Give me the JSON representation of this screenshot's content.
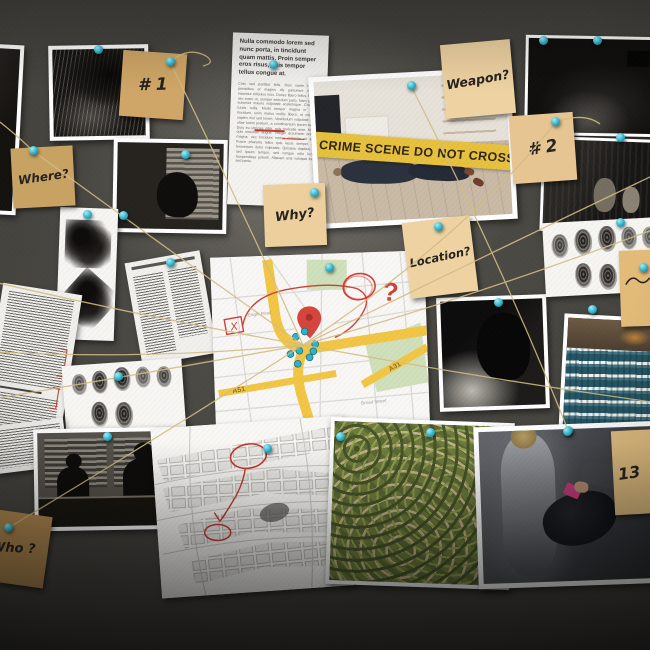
{
  "scene": {
    "description": "Detective evidence board: photos, sticky notes, maps, fingerprints and newspaper clippings connected by string and turquoise push pins",
    "surface": "gray felt pinboard"
  },
  "colors": {
    "board_felt": "#46443f",
    "sticky_note": "#e3c491",
    "push_pin": "#2fb3c9",
    "string": "#d2bc84",
    "crime_tape": "#e7c13d",
    "red_annotation": "#cc3b32"
  },
  "notes": {
    "n1": {
      "label": "# 1"
    },
    "where": {
      "label": "Where?"
    },
    "why": {
      "label": "Why?"
    },
    "weapon": {
      "label": "Weapon?"
    },
    "n2": {
      "label": "# 2"
    },
    "location": {
      "label": "Location?"
    },
    "n13": {
      "label": "13"
    },
    "who": {
      "label": "Who ?"
    },
    "edge": {
      "label": ""
    }
  },
  "crime_scene": {
    "tape_text": "CRIME SCENE DO NOT CROSS"
  },
  "newspaper": {
    "headline": "Nulla commodo lorem sed nunc porta, in tincidunt quam mattis. Proin semper eros risus, quis tempor tellus congue at.",
    "body": "Cras sed porttitor felis. Duis sante natoque penatibus et magnis dis parturient montes, nascetur ridiculus mus. Donec libero tellus, facilisis nec tortor ut, semper interdum justo. Nam gravida euismod mauris vulputate scelerisque. Cras nec turpis nulla. Morbi tempor magna in varius tincidunt, enim metus mollis libero, ut convallis sapien nisl sed lorem. Vestibulum vulputate libero vitae lorem pretium, a condimentum ipsum iaculis. Duis eu ultricies nibh, quis molestie ante. Mauris quis interdum augue. Integer accumsan pretium magna, nec tincidunt metus molestie sit amet. Fusce pharetra tellus quis lacus semper, quis fermentum dolor vulputate. Quisque dapibus orci sed ipsum tempor, sed congue odio luctus. Suspendisse potenti. Aliquam erat volutpat lorem sed porta."
  },
  "map": {
    "motorway_label_1": "A51",
    "motorway_label_2": "A31",
    "street_1": "Eagle Road",
    "street_2": "Broad Street",
    "question_mark": "?",
    "x_mark": "X"
  }
}
